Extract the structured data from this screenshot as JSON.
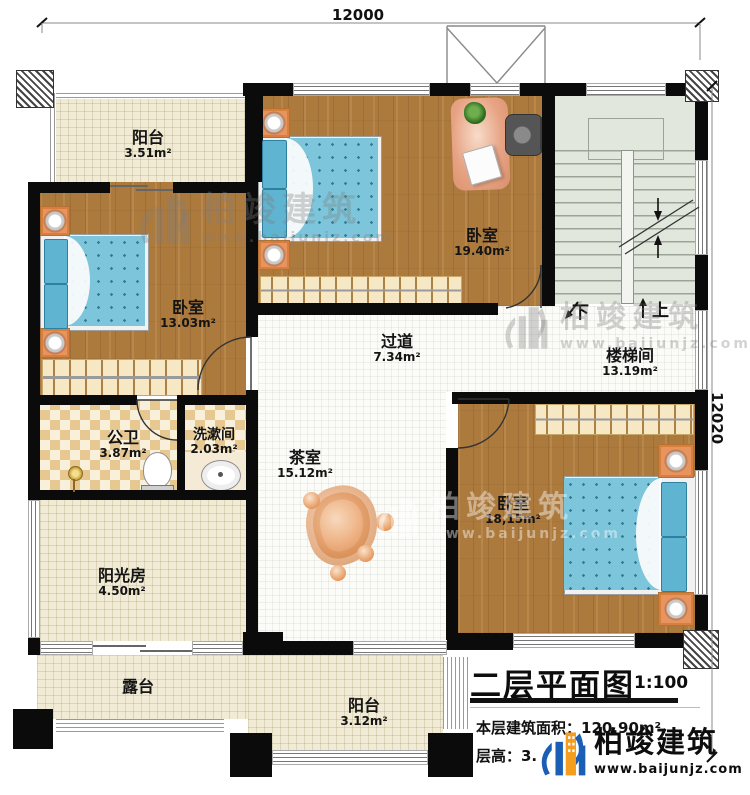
{
  "dimensions": {
    "top": "12000",
    "right": "12020"
  },
  "rooms": {
    "balcony_top": {
      "name": "阳台",
      "area": "3.51m²"
    },
    "bedroom_top": {
      "name": "卧室",
      "area": "19.40m²"
    },
    "stairwell": {
      "name": "楼梯间",
      "area": "13.19m²"
    },
    "bedroom_left": {
      "name": "卧室",
      "area": "13.03m²"
    },
    "corridor": {
      "name": "过道",
      "area": "7.34m²"
    },
    "bathroom": {
      "name": "公卫",
      "area": "3.87m²"
    },
    "washroom": {
      "name": "洗漱间",
      "area": "2.03m²"
    },
    "tearoom": {
      "name": "茶室",
      "area": "15.12m²"
    },
    "bedroom_br": {
      "name": "卧室",
      "area": "18,15m²"
    },
    "sunroom": {
      "name": "阳光房",
      "area": "4.50m²"
    },
    "terrace": {
      "name": "露台"
    },
    "balcony_bottom": {
      "name": "阳台",
      "area": "3.12m²"
    }
  },
  "stairs": {
    "down_label": "下",
    "up_label": "上"
  },
  "title_block": {
    "title": "二层平面图",
    "scale": "1:100",
    "area_line": "本层建筑面积：120.90m²",
    "height_line": "层高：3."
  },
  "brand": {
    "name": "柏竣建筑",
    "website": "www.baijunjz.com"
  },
  "colors": {
    "wall": "#0b0b0b",
    "wood": "#ad7a3e",
    "cream": "#f1ebd5",
    "white_grid": "#fbfbf8",
    "stair": "#e1e7dd",
    "checker": "#e7c890",
    "bed_blue": "#7cc5da",
    "accent_orange": "#e8945f",
    "logo_blue": "#1a5fb4",
    "logo_orange": "#f59d1e"
  }
}
